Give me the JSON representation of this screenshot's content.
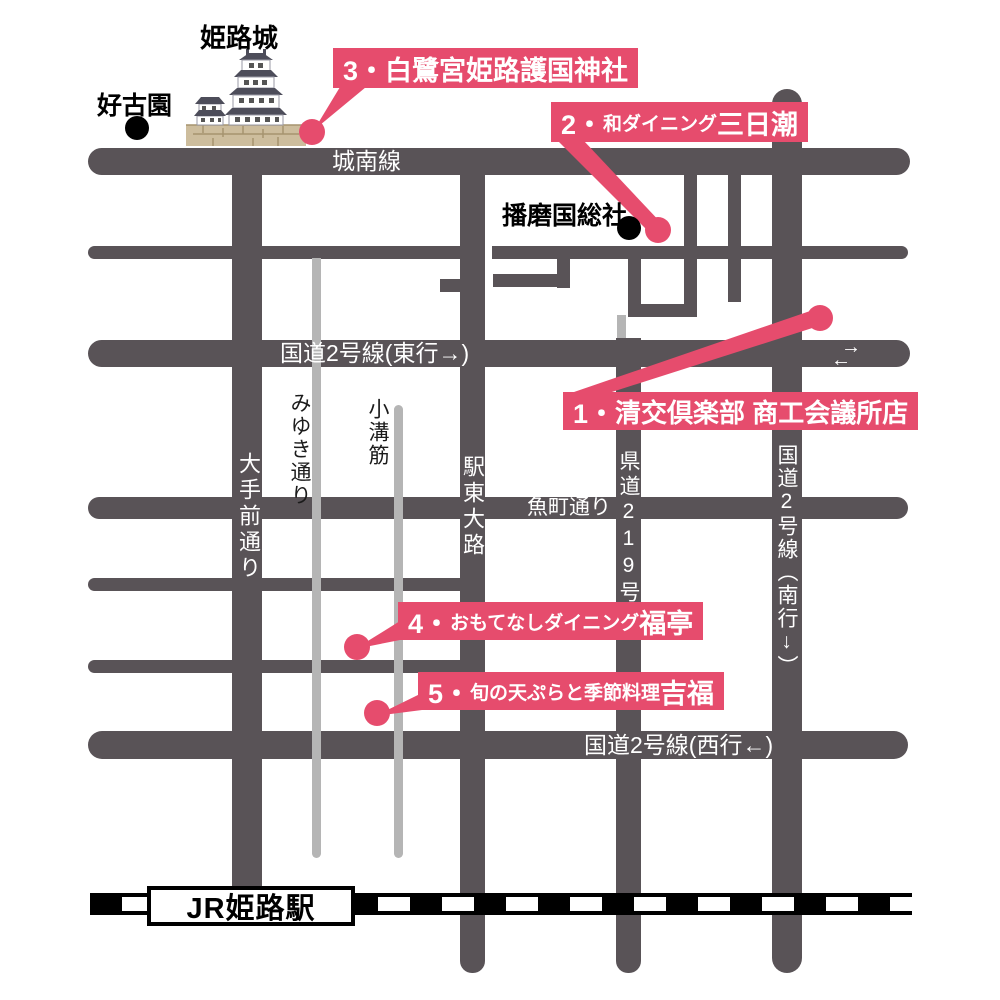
{
  "landmarks": {
    "castle": "姫路城",
    "garden": "好古園",
    "shrine": "播磨国総社",
    "station": "JR姫路駅"
  },
  "roads": {
    "jonan": "城南線",
    "route2_east": "国道2号線(東行→)",
    "otemae": "大手前通り",
    "miyuki": "みゆき通り",
    "komizo": "小溝筋",
    "ekito": "駅東大路",
    "uomachi": "魚町通り",
    "kendo219": "県道219号",
    "route2_south": "国道2号線︵南行↓︶",
    "route2_west": "国道2号線(西行←)"
  },
  "markers": {
    "m1": {
      "prefix": "1・",
      "small": "",
      "large": "清交倶楽部 商工会議所店"
    },
    "m2": {
      "prefix": "2・",
      "small": "和ダイニング",
      "large": "三日潮"
    },
    "m3": {
      "prefix": "3・",
      "small": "",
      "large": "白鷺宮姫路護国神社"
    },
    "m4": {
      "prefix": "4・",
      "small": "おもてなしダイニング",
      "large": "福亭"
    },
    "m5": {
      "prefix": "5・",
      "small": "旬の天ぷらと季節料理",
      "large": "吉福"
    }
  },
  "arrows": {
    "east": "→",
    "west": "←"
  },
  "colors": {
    "road": "#595357",
    "road_light": "#b5b5b5",
    "accent_pink": "#e64c6d",
    "black": "#000000"
  }
}
